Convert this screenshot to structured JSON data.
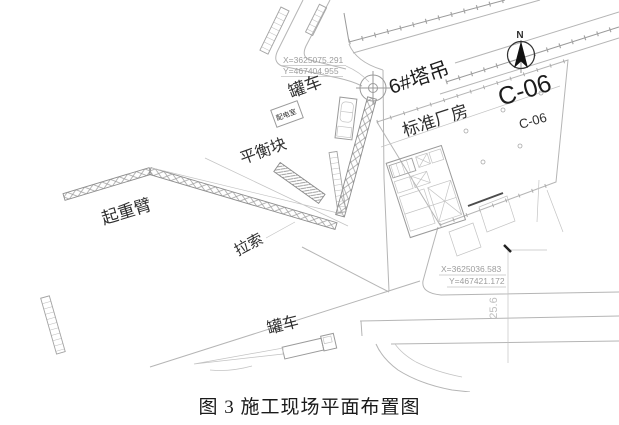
{
  "figure": {
    "caption": "图 3 施工现场平面布置图"
  },
  "compass": {
    "north_label": "N"
  },
  "labels": {
    "tank_truck_top": "罐车",
    "tower_crane": "6#塔吊",
    "factory_building": "标准厂房",
    "block_code_large": "C-06",
    "block_code_small": "C-06",
    "power_room": "配电室",
    "counterweight": "平衡块",
    "crane_jib": "起重臂",
    "guy_cable": "拉索",
    "tank_truck_bottom": "罐车",
    "dimension": "25.6"
  },
  "survey_points": [
    {
      "x_label": "X=3625075.291",
      "y_label": "Y=467404.955"
    },
    {
      "x_label": "X=3625036.583",
      "y_label": "Y=467421.172"
    }
  ],
  "colors": {
    "background": "#ffffff",
    "cad_line_light": "#b5b5b5",
    "cad_line_mid": "#9a9a9a",
    "label_text": "#2f2f2f",
    "coordinate_text": "#9c9c9c",
    "dimension_text": "#c0c0c0",
    "north_arrow": "#111111",
    "caption_text": "#1a1a1a"
  }
}
